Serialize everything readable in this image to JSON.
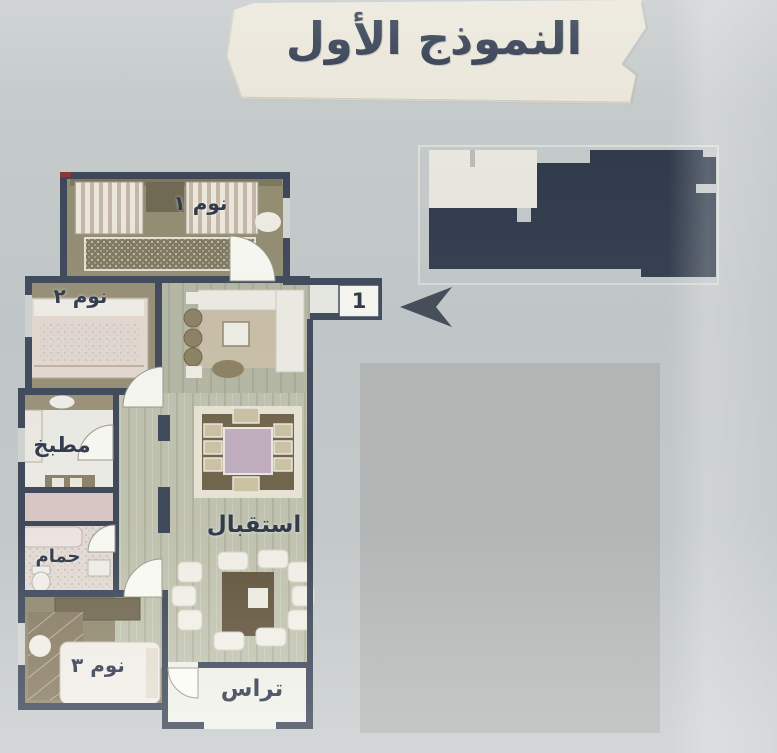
{
  "title": "النموذج الأول",
  "entrance_badge": "1",
  "rooms": {
    "bedroom1": {
      "label": "نوم ١"
    },
    "bedroom2": {
      "label": "نوم ٢"
    },
    "bedroom3": {
      "label": "نوم ٣"
    },
    "kitchen": {
      "label": "مطبخ"
    },
    "bathroom": {
      "label": "حمام"
    },
    "reception": {
      "label": "استقبال"
    },
    "terrace": {
      "label": "تراس"
    }
  },
  "icons": {
    "direction_arrow": "left-arrowhead-icon",
    "key_plan": "building-key-plan"
  },
  "colors": {
    "background": "#c5cacb",
    "banner_paper": "#eae6da",
    "title_text": "#2e3a4e",
    "wall": "#3a4456",
    "key_plan_dark": "#2e3849",
    "key_plan_unit": "#eae8df",
    "placeholder_gray": "#b4b7b6",
    "bedroom_floor": "#938c70",
    "reception_floor": "#c2c4b0",
    "accent_red": "#8d3335"
  }
}
